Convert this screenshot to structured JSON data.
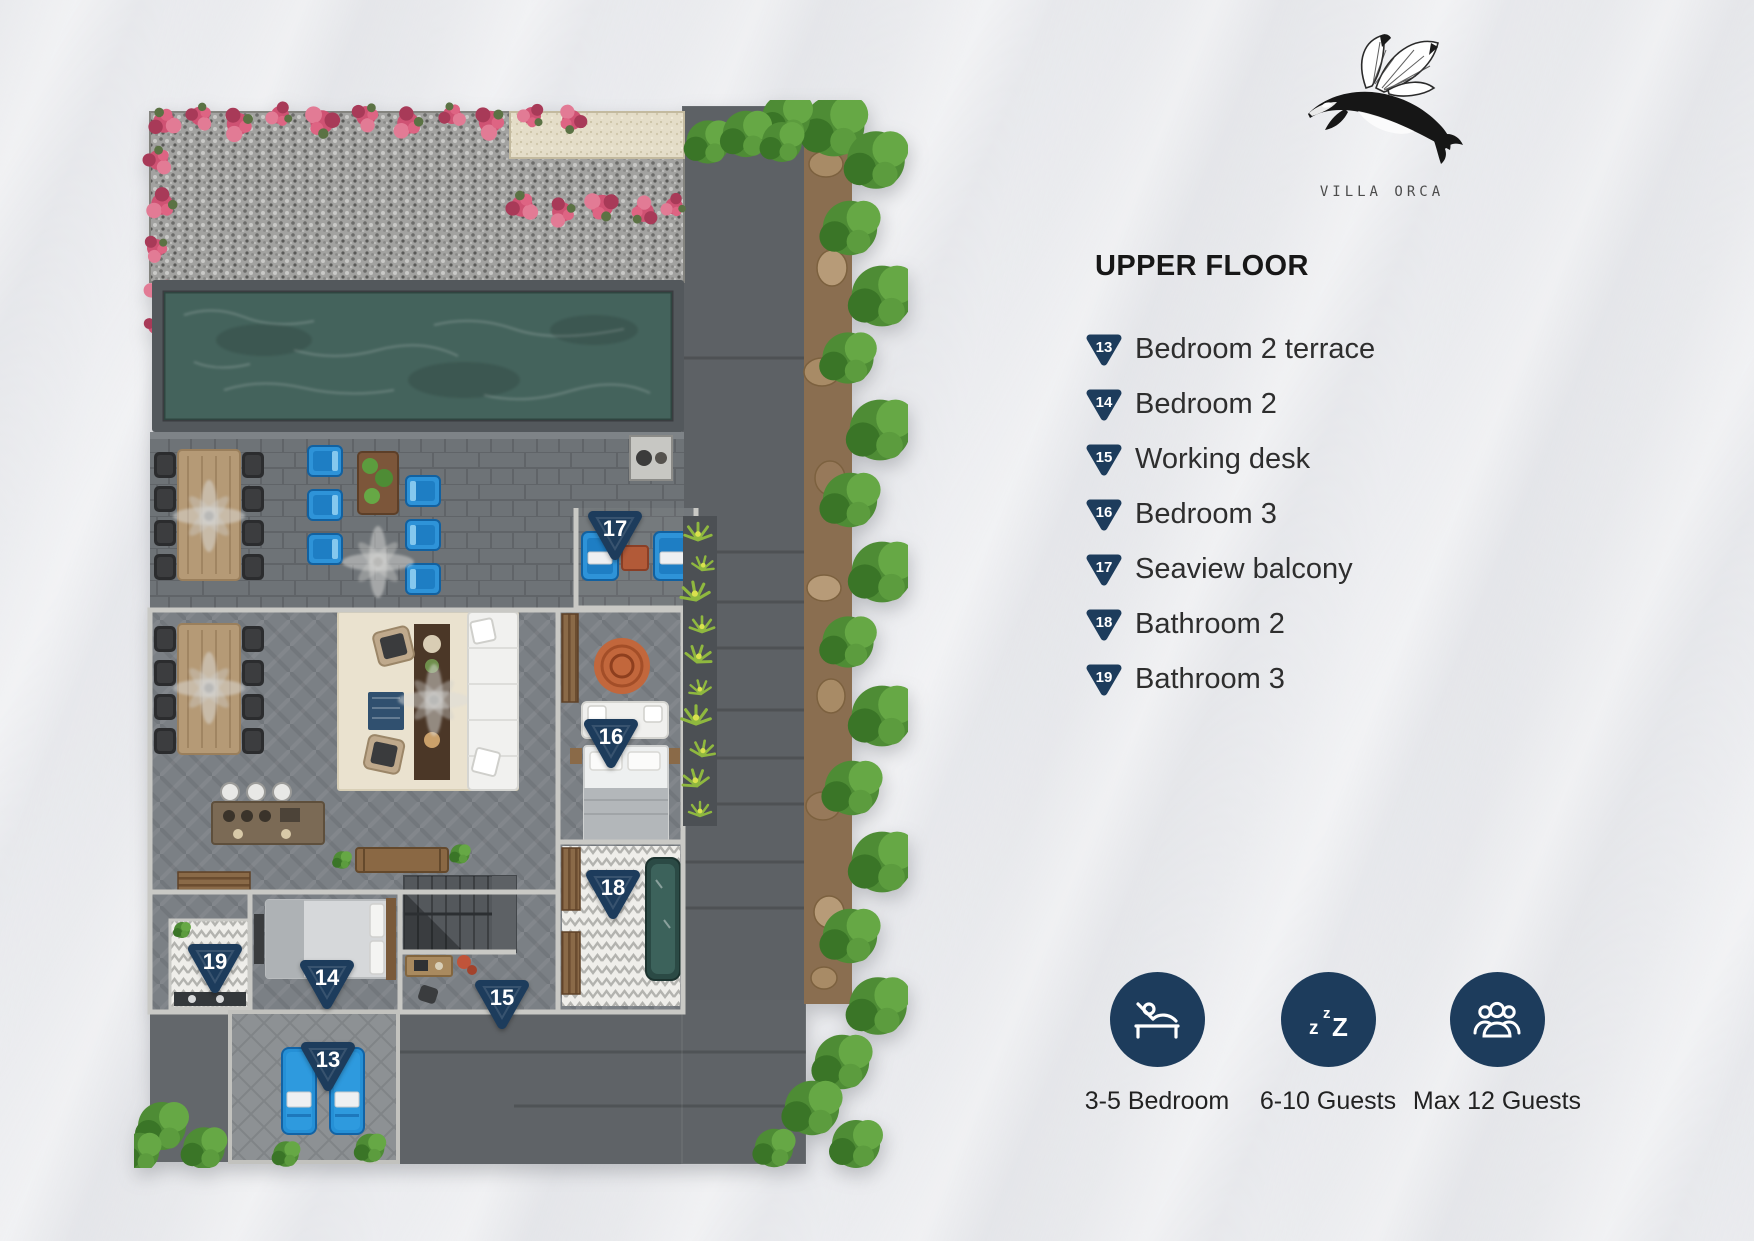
{
  "brand": {
    "name": "VILLA ORCA"
  },
  "panel": {
    "heading": "UPPER FLOOR",
    "legend": [
      {
        "num": "13",
        "label": "Bedroom 2 terrace"
      },
      {
        "num": "14",
        "label": "Bedroom 2"
      },
      {
        "num": "15",
        "label": "Working desk"
      },
      {
        "num": "16",
        "label": "Bedroom 3"
      },
      {
        "num": "17",
        "label": "Seaview balcony"
      },
      {
        "num": "18",
        "label": "Bathroom 2"
      },
      {
        "num": "19",
        "label": "Bathroom 3"
      }
    ],
    "stats": [
      {
        "icon": "bed-icon",
        "label": "3-5 Bedroom"
      },
      {
        "icon": "sleep-icon",
        "label": "6-10 Guests"
      },
      {
        "icon": "guests-icon",
        "label": "Max 12 Guests"
      }
    ]
  },
  "plan_markers": {
    "m13": "13",
    "m14": "14",
    "m15": "15",
    "m16": "16",
    "m17": "17",
    "m18": "18",
    "m19": "19"
  },
  "colors": {
    "navy": "#1d3c5c",
    "chair_blue": "#2e93d8",
    "pool_water": "#44635c"
  }
}
